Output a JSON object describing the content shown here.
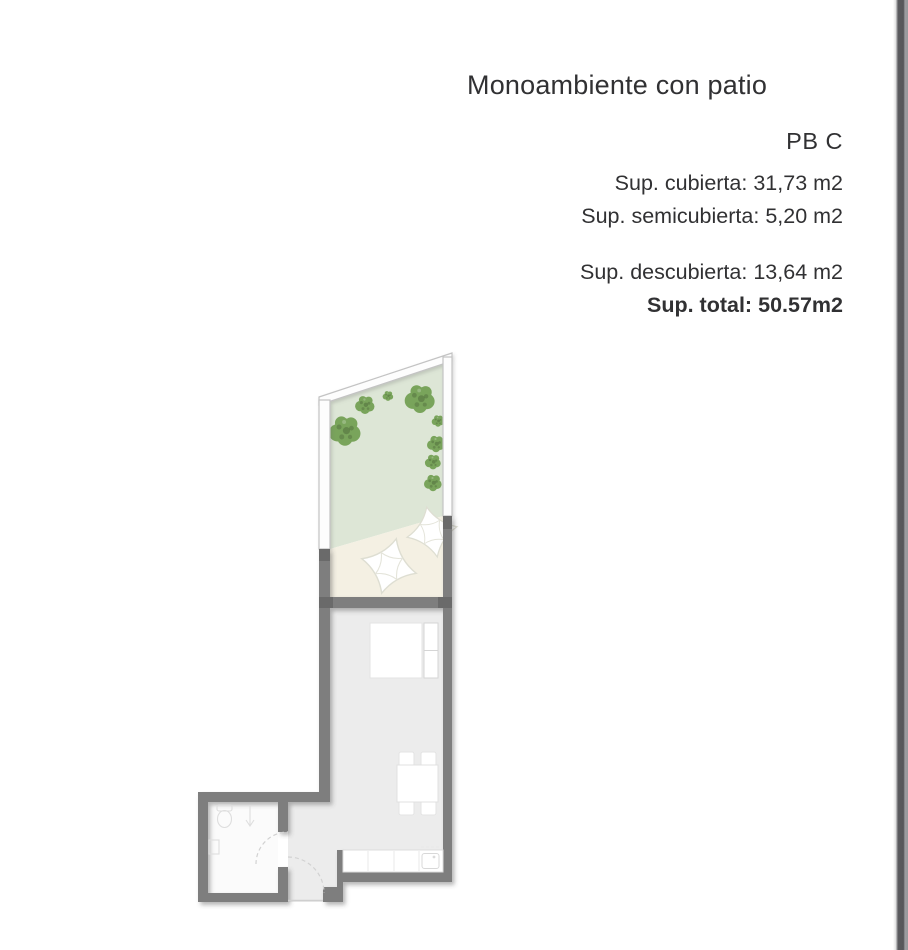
{
  "title": "Monoambiente con patio",
  "summary": {
    "unit": "PB C",
    "rows": [
      {
        "label": "Sup. cubierta:",
        "value": "31,73 m2"
      },
      {
        "label": "Sup. semicubierta:",
        "value": "5,20 m2"
      },
      {
        "label": "Sup. descubierta:",
        "value": "13,64 m2"
      },
      {
        "label": "Sup. total:",
        "value": "50.57m2"
      }
    ]
  },
  "floorplan": {
    "colors": {
      "patio_green": "#dde6d6",
      "semicover_cream": "#f4f0e3",
      "floor_gray": "#ececec",
      "bathroom_floor": "#fbfbfb",
      "wall_gray": "#7e7e7e",
      "wall_dark": "#6a6a6a",
      "bush_green": "#79a45b",
      "glass_wall_stroke": "#c3c3c3",
      "edge_strip": "#59595d"
    }
  }
}
